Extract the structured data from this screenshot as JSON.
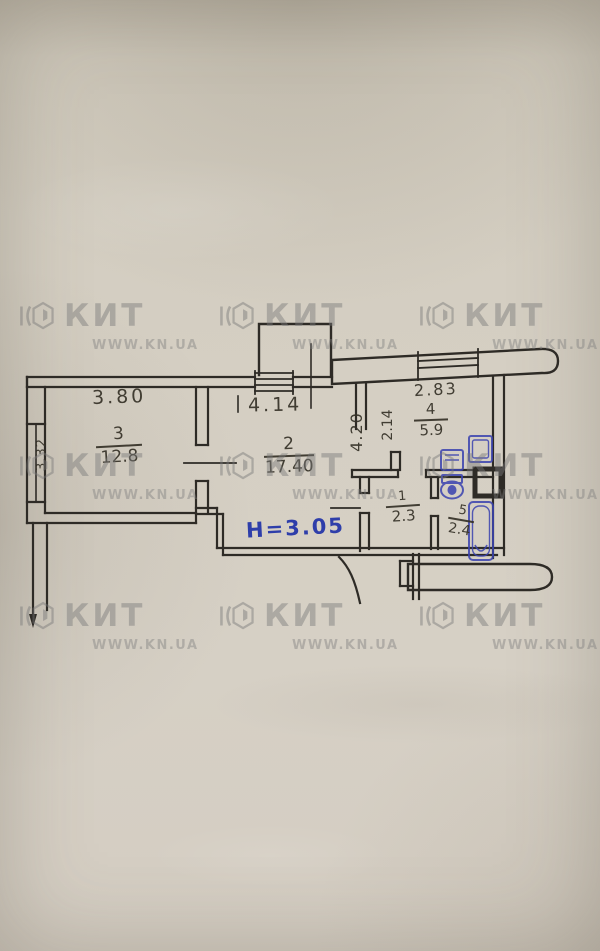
{
  "watermark": {
    "brand": "КИТ",
    "url": "WWW.KN.UA"
  },
  "plan": {
    "height_note": "H=3.05",
    "rooms": {
      "living": {
        "number": "3",
        "area": "12.8"
      },
      "main": {
        "number": "2",
        "area": "17.40"
      },
      "kitchen": {
        "number": "4",
        "area": "5.9"
      },
      "hall": {
        "number": "1",
        "area": "2.3"
      },
      "bath": {
        "number": "5",
        "area": "2.4"
      }
    },
    "dims": {
      "top_left": "3.80",
      "left_vert": "3.32",
      "top_center": "4.14",
      "center_vert": "4.20",
      "mid_vert": "2.14",
      "top_right": "2.83"
    },
    "colors": {
      "ink": "#2e2b26",
      "blue_ink": "#2a3aad",
      "paper": "#d5cfc3",
      "watermark": "#7d7d7d"
    }
  }
}
